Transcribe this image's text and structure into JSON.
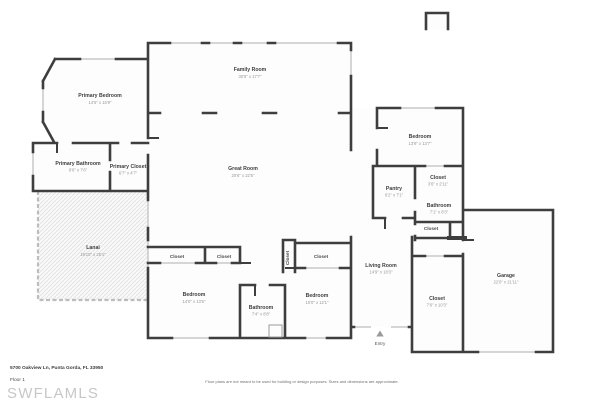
{
  "meta": {
    "type": "floor-plan"
  },
  "colors": {
    "wall": "#3e3e3e",
    "window": "#c8c8c8",
    "room_fill": "#fdfdfd",
    "lanai_border": "#bdbdbd",
    "label": "#3f3f3f",
    "dims": "#979797",
    "watermark": "#c7c7c7"
  },
  "rooms": {
    "family_room": {
      "name": "Family Room",
      "dims": "30'8\" x 17'7\""
    },
    "great_room": {
      "name": "Great Room",
      "dims": "20'6\" x 22'5\""
    },
    "primary_bedroom": {
      "name": "Primary Bedroom",
      "dims": "14'5\" x 15'9\""
    },
    "primary_bathroom": {
      "name": "Primary Bathroom",
      "dims": "8'6\" x 7'6\""
    },
    "primary_closet": {
      "name": "Primary Closet",
      "dims": "6'7\" x 4'7\""
    },
    "lanai": {
      "name": "Lanai",
      "dims": "19'10\" x 25'1\""
    },
    "bedroom_tr": {
      "name": "Bedroom",
      "dims": "13'9\" x 13'7\""
    },
    "pantry": {
      "name": "Pantry",
      "dims": "6'2\" x 7'1\""
    },
    "closet_tr": {
      "name": "Closet",
      "dims": "3'6\" x 2'11\""
    },
    "bathroom_r": {
      "name": "Bathroom",
      "dims": "7'1\" x 8'3\""
    },
    "closet_r": {
      "name": "Closet"
    },
    "living_room": {
      "name": "Living Room",
      "dims": "14'9\" x 18'3\""
    },
    "entry": {
      "name": "Entry"
    },
    "closet_garage": {
      "name": "Closet",
      "dims": "7'6\" x 10'3\""
    },
    "garage": {
      "name": "Garage",
      "dims": "22'0\" x 21'11\""
    },
    "bedroom_bl": {
      "name": "Bedroom",
      "dims": "14'0\" x 13'5\""
    },
    "bathroom_b": {
      "name": "Bathroom",
      "dims": "7'4\" x 8'8\""
    },
    "bedroom_bc": {
      "name": "Bedroom",
      "dims": "10'0\" x 12'1\""
    },
    "closet_b1": {
      "name": "Closet"
    },
    "closet_b2": {
      "name": "Closet"
    },
    "closet_bed2": {
      "name": "Closet"
    },
    "closet_narrow": {
      "name": "Closet"
    }
  },
  "footer": {
    "address": "5700 Oakview Ln, Punta Gorda, FL 33950",
    "floor_label": "Floor 1",
    "watermark": "SWFLAMLS",
    "disclaimer": "Floor plans are not meant to be used for building or design purposes. Sizes and dimensions are approximate."
  }
}
